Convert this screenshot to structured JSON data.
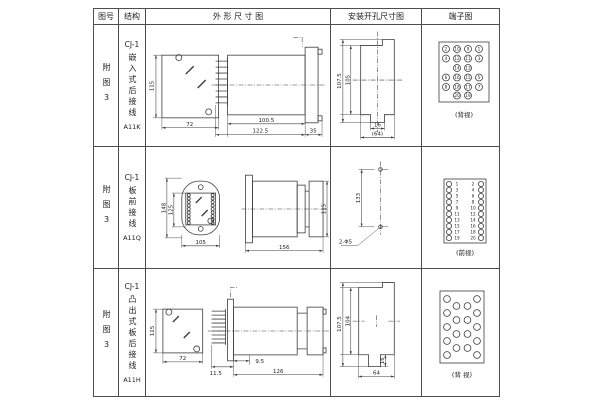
{
  "table": {
    "headers": [
      {
        "label": "图号"
      },
      {
        "label": "结构"
      },
      {
        "label": "外 形 尺 寸 图"
      },
      {
        "label": "安装开孔尺寸图"
      },
      {
        "label": "端子图"
      }
    ],
    "rows": [
      {
        "figure_no": {
          "text": "附图3"
        },
        "structure": {
          "model": "CJ-1",
          "type": "嵌入式后接线",
          "code": "A11K"
        },
        "outline": {
          "front_height": "115",
          "front_width": "72",
          "side_body": "100.5",
          "side_total": "122.5",
          "side_flange": "35"
        },
        "mounting": {
          "outer_height": "107.5",
          "inner_height": "105",
          "slot_width": "16",
          "overall_width": "(64)"
        },
        "terminal": {
          "caption": "(背视)",
          "outer_left": [
            "2",
            "4",
            "6",
            "8"
          ],
          "mid_left": [
            "10",
            "12",
            "14",
            "16",
            "18",
            "20"
          ],
          "mid_right": [
            "9",
            "11",
            "13",
            "15",
            "17",
            "19"
          ],
          "outer_right": [
            "1",
            "3",
            "5",
            "7"
          ]
        }
      },
      {
        "figure_no": {
          "text": "附图3"
        },
        "structure": {
          "model": "CJ-1",
          "type": "板前接线",
          "code": "A11Q"
        },
        "outline": {
          "front_outer_height": "148",
          "front_inner_height": "125",
          "front_width": "105",
          "side_length": "156",
          "side_height": "115"
        },
        "mounting": {
          "hole_spacing": "133",
          "hole_label": "2-Φ5"
        },
        "terminal": {
          "caption": "(前视)",
          "left_numbers": [
            "1",
            "3",
            "5",
            "7",
            "9",
            "11",
            "13",
            "15",
            "17",
            "19"
          ],
          "right_numbers": [
            "2",
            "4",
            "6",
            "8",
            "10",
            "12",
            "14",
            "16",
            "18",
            "20"
          ]
        }
      },
      {
        "figure_no": {
          "text": "附图3"
        },
        "structure": {
          "model": "CJ-1",
          "type": "凸出式板后接线",
          "code": "A11H"
        },
        "outline": {
          "front_height": "115",
          "front_width": "72",
          "side_comb": "11.5",
          "side_offset": "9.5",
          "side_length": "126"
        },
        "mounting": {
          "outer_height": "107.5",
          "inner_height": "104",
          "tab_height": "16",
          "overall_width": "64"
        },
        "terminal": {
          "caption": "(背 视)"
        }
      }
    ]
  }
}
